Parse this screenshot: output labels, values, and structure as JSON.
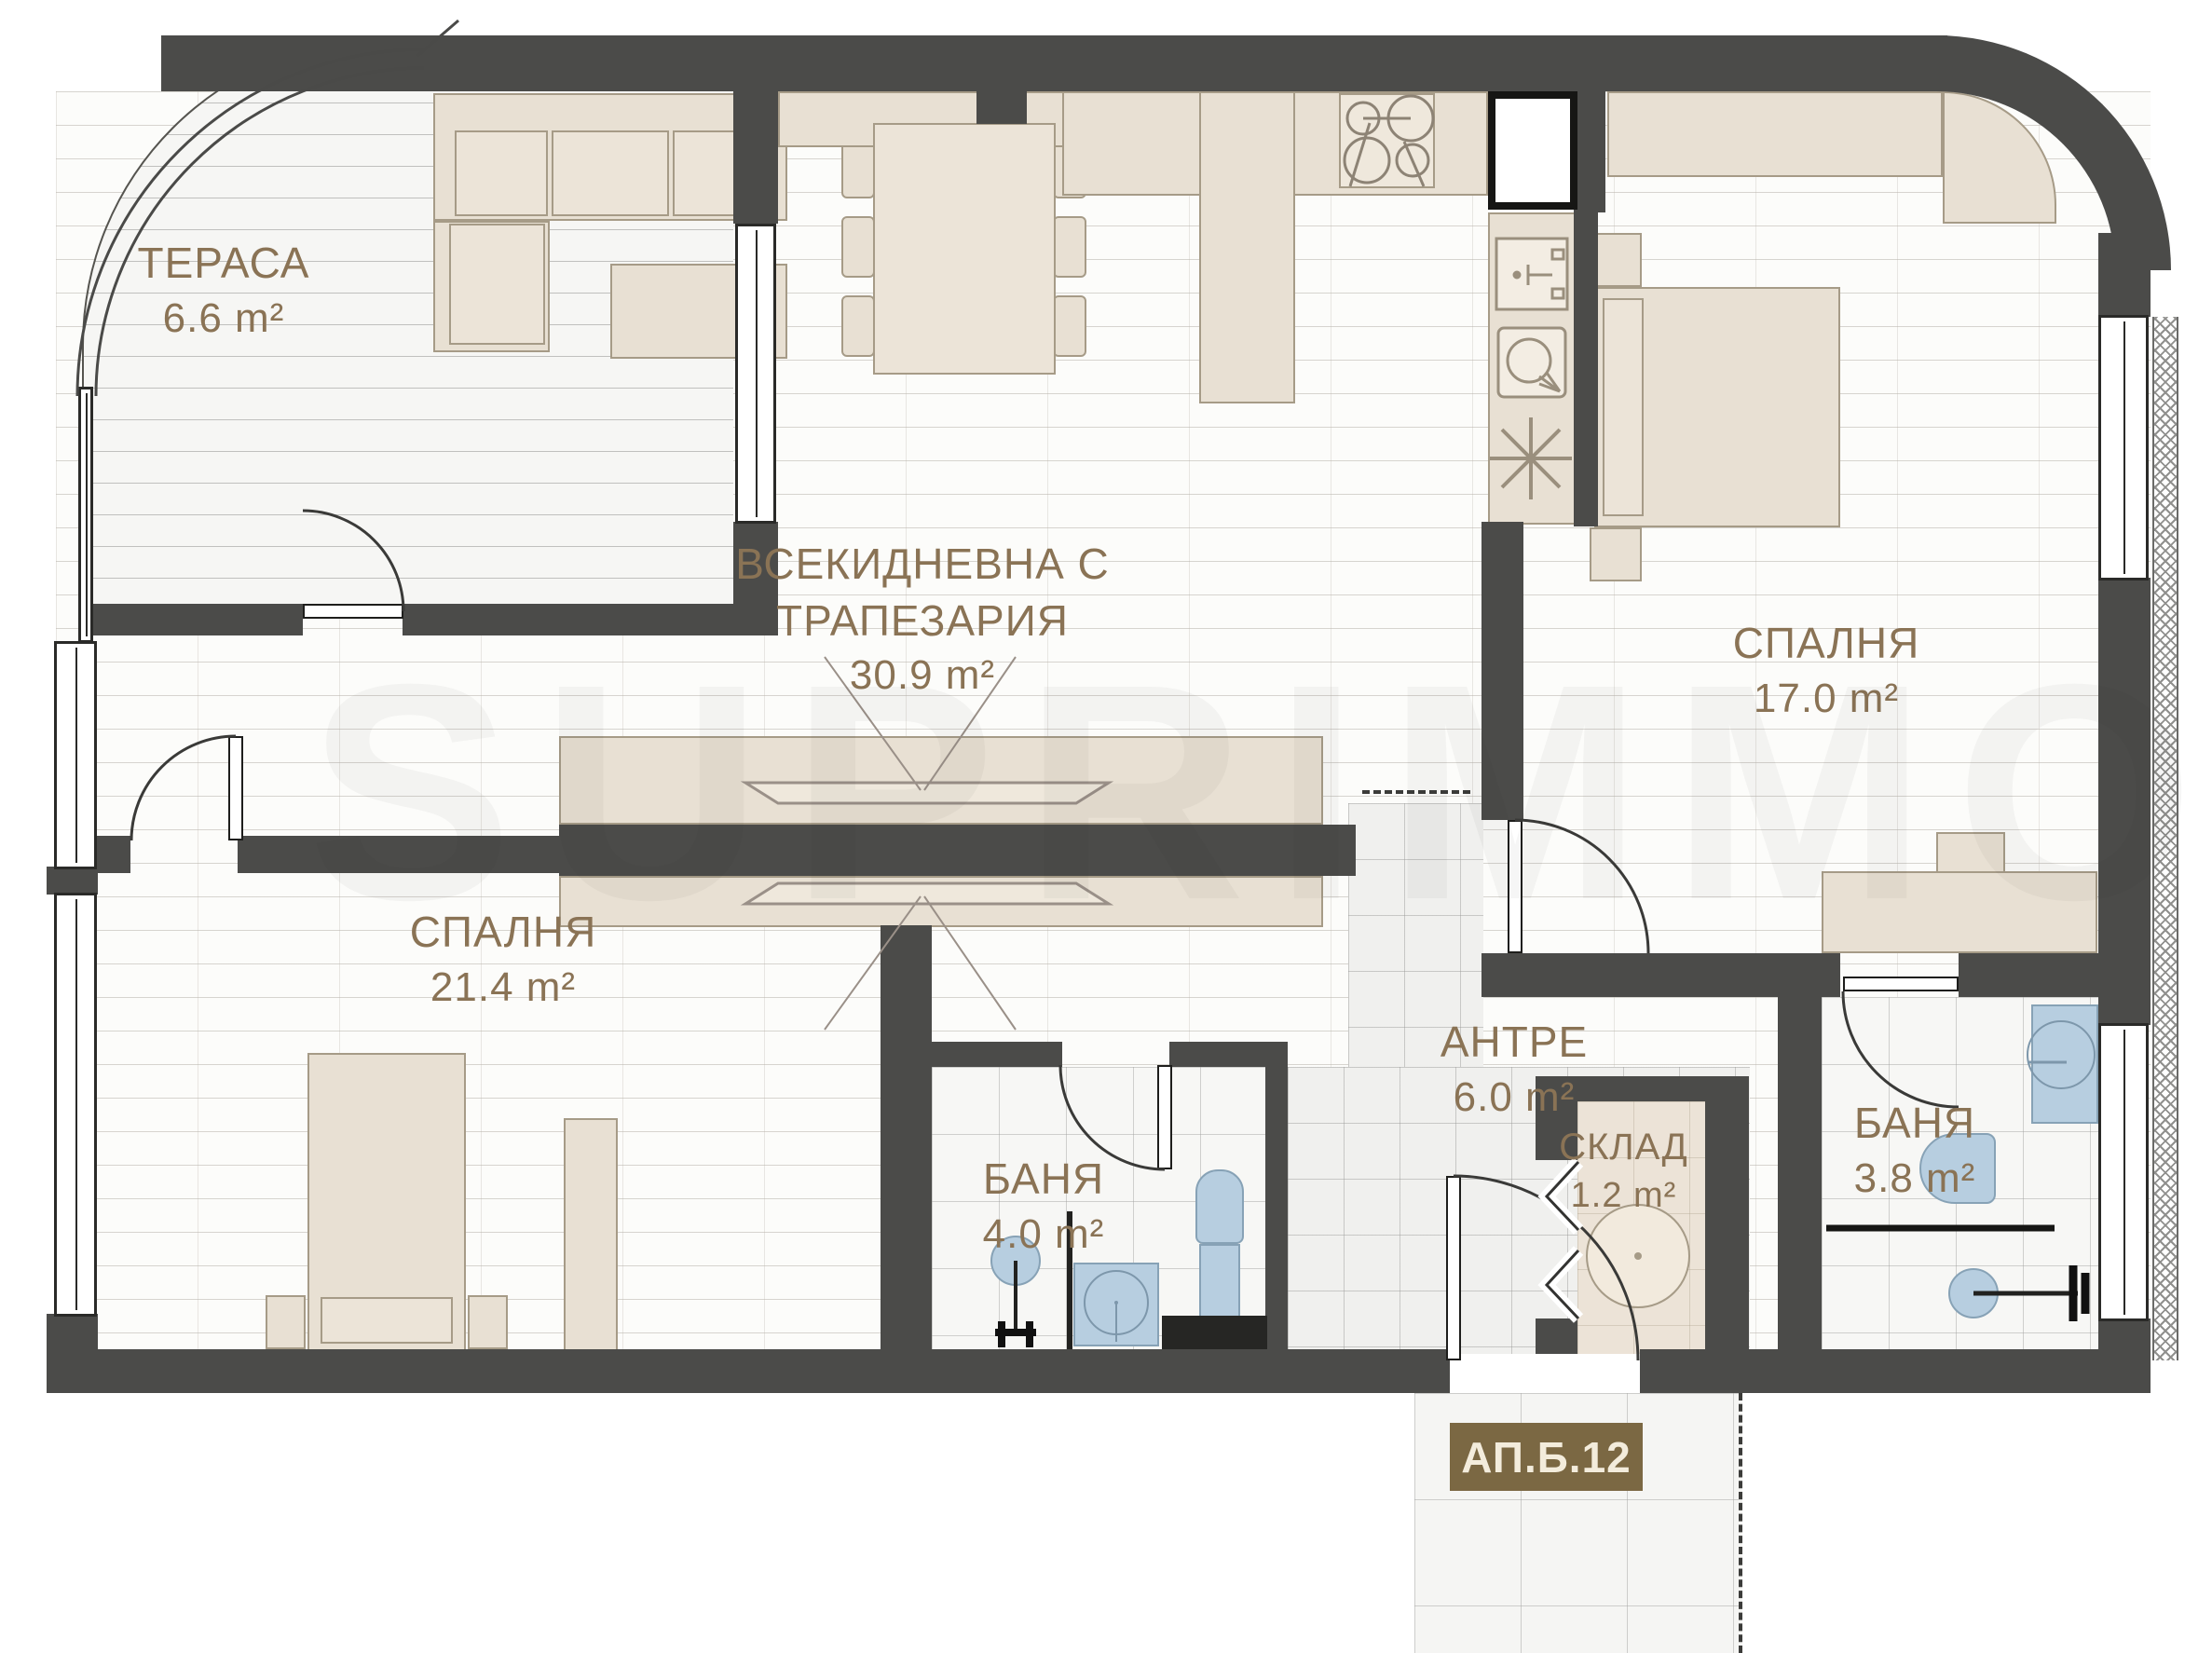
{
  "plan": {
    "badge": "АП.Б.12",
    "watermark": "SUPRIMMO",
    "unit": "m²"
  },
  "rooms": [
    {
      "id": "terrace",
      "name": "ТЕРАСА",
      "area": "6.6 m²"
    },
    {
      "id": "living-dining",
      "name": "ВСЕКИДНЕВНА С",
      "name_line2": "ТРАПЕЗАРИЯ",
      "area": "30.9 m²"
    },
    {
      "id": "bedroom-right",
      "name": "СПАЛНЯ",
      "area": "17.0 m²"
    },
    {
      "id": "bedroom-left",
      "name": "СПАЛНЯ",
      "area": "21.4 m²"
    },
    {
      "id": "entry-hall",
      "name": "АНТРЕ",
      "area": "6.0 m²"
    },
    {
      "id": "bathroom-left",
      "name": "БАНЯ",
      "area": "4.0 m²"
    },
    {
      "id": "bathroom-right",
      "name": "БАНЯ",
      "area": "3.8 m²"
    },
    {
      "id": "storage",
      "name": "СКЛАД",
      "area": "1.2 m²"
    }
  ],
  "colors": {
    "wall": "#4b4b49",
    "furniture": "#e8e0d3",
    "furniture_border": "#a69b87",
    "fixture_blue": "#b7cee0",
    "label_text": "#8a7355",
    "badge_bg": "#7b6843",
    "badge_text": "#f3ecdc"
  }
}
